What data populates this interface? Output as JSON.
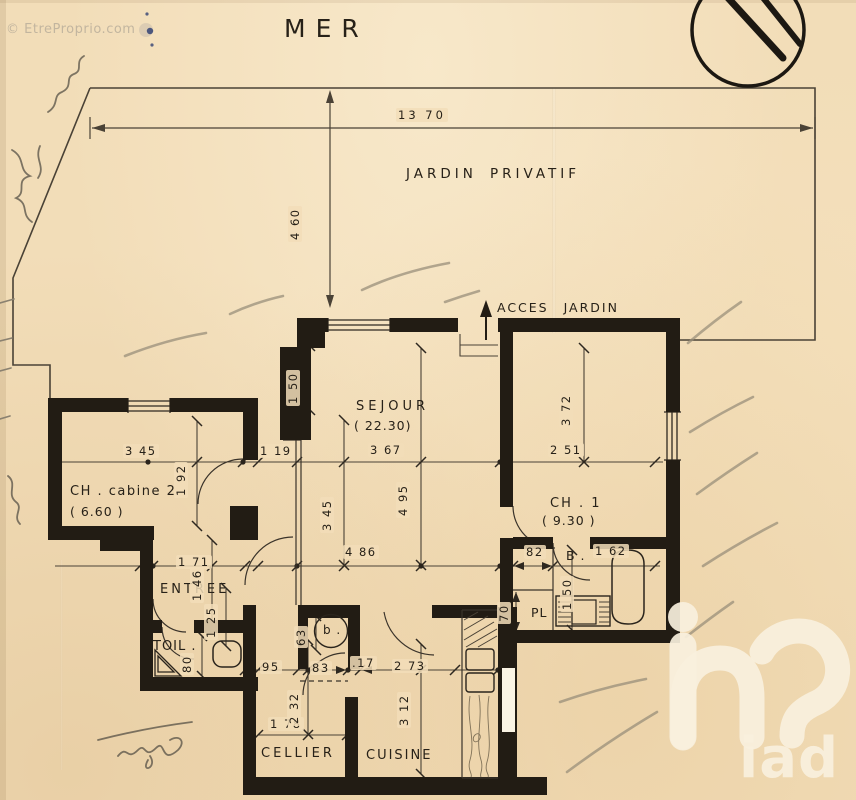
{
  "meta": {
    "watermark": "© EtreProprio.com",
    "title": "MER",
    "logo_text": "iad"
  },
  "garden": {
    "label_word1": "JARDIN",
    "label_word2": "PRIVATIF",
    "access_label": "ACCES JARDIN",
    "width_dim": "13 70",
    "depth_dim": "4 60"
  },
  "rooms": {
    "sejour": {
      "name": "SEJOUR",
      "area": "( 22.30)"
    },
    "ch1": {
      "name": "CH . 1",
      "area": "( 9.30 )"
    },
    "cabine": {
      "name": "CH . cabine 2",
      "area": "( 6.60 )"
    },
    "entree": {
      "name": "ENTREE"
    },
    "toilettes": {
      "name": "TOIL ."
    },
    "cellier": {
      "name": "CELLIER"
    },
    "cuisine": {
      "name": "CUISINE"
    },
    "bain": {
      "name": "B ."
    },
    "placard": {
      "name": "PL"
    },
    "ballon": {
      "name": "b ."
    }
  },
  "dims": {
    "sejour_offset": "1 50",
    "cabine_w": "3 45",
    "hall_w": "1 19",
    "sejour_w": "3 67",
    "ch1_w": "2 51",
    "ch1_h": "3 72",
    "cabine_h": "1 92",
    "sejour_h": "4 95",
    "sejour_h2": "3 45",
    "sejour_w2": "4 86",
    "entree_w": "1 71",
    "entree_h": "1 46",
    "entree_h2": "1 25",
    "toil_w": "80",
    "bath_off": "82",
    "bath_w": "1 62",
    "bath_h": "1 50",
    "pl_w": "70",
    "ballon_h": "63",
    "hall2_w": "95",
    "hall3_w": "83",
    "wall_t": ".17",
    "cuisine_w": "2 73",
    "cellier_h": "2 32",
    "cellier_w": "1 78",
    "cuisine_h": "3 12"
  },
  "colors": {
    "paper": "#f2ddb8",
    "wall": "#221c14",
    "ink": "#272118",
    "pencil": "#978d79",
    "logo": "#f7efdb"
  }
}
